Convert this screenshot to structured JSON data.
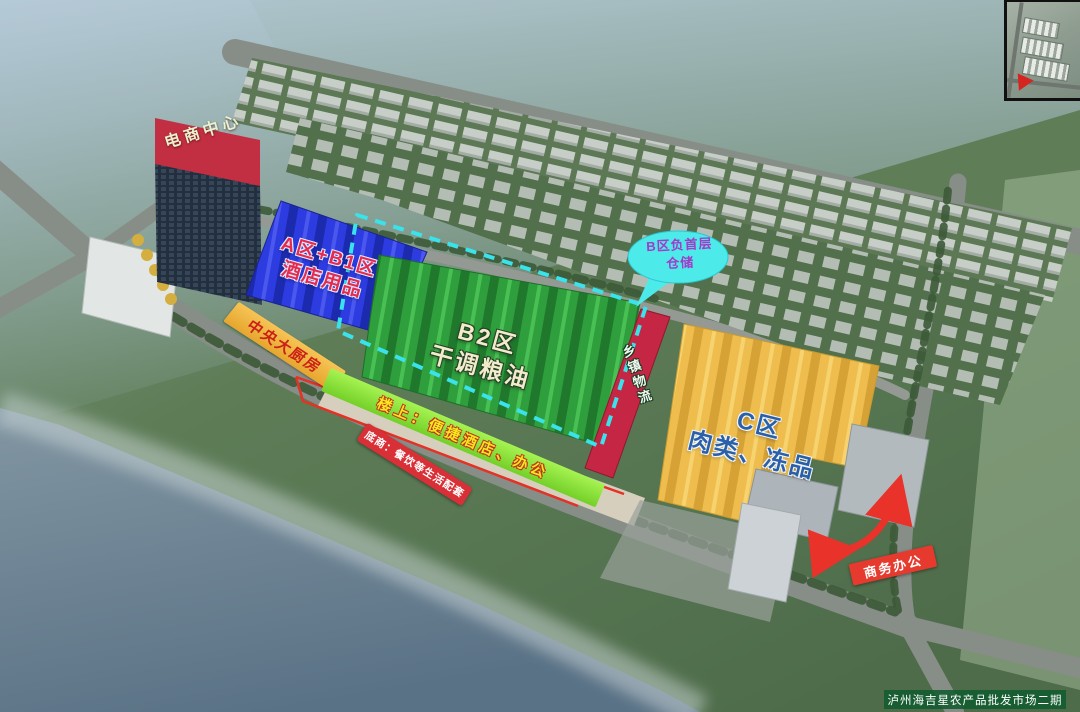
{
  "scene": {
    "watermark": "泸州海吉星农产品批发市场二期"
  },
  "zones": {
    "ecommerce": {
      "label": "电商中心",
      "fill": "#c22f42",
      "text_color": "#e8f2cf"
    },
    "zone_ab1": {
      "line1": "A区+B1区",
      "line2": "酒店用品",
      "fill": "#2c3ce0",
      "text_color": "#e62a4e"
    },
    "zone_b2": {
      "line1": "B2区",
      "line2": "干调粮油",
      "fill": "#2f9e3c",
      "text_color": "#f2ecca"
    },
    "zone_b_basement": {
      "line1": "B区负首层",
      "line2": "仓储",
      "fill": "#4deaea",
      "text_color": "#a23cc8"
    },
    "township_logistics": {
      "label": "乡镇物流",
      "fill": "#c42644",
      "text_color": "#f0f8f0"
    },
    "zone_c": {
      "line1": "C区",
      "line2": "肉类、冻品",
      "fill": "#eebd4e",
      "text_color": "#2b5fa8"
    },
    "central_kitchen": {
      "label": "中央大厨房",
      "fill": "#f4bc4a",
      "text_color": "#cc2016"
    },
    "upstairs": {
      "label": "楼上：便捷酒店、办公",
      "fill": "#8ce93e",
      "text_color": "#f6e81e"
    },
    "ground_floor": {
      "label": "底商：餐饮等生活配套",
      "fill": "#d93038",
      "text_color": "#ffffff"
    },
    "business_office": {
      "label": "商务办公",
      "fill": "#e63a2e",
      "text_color": "#ffffff"
    }
  },
  "annotations": {
    "basement_boundary_color": "#3ae2ec",
    "arrow_color": "#e8322a"
  }
}
